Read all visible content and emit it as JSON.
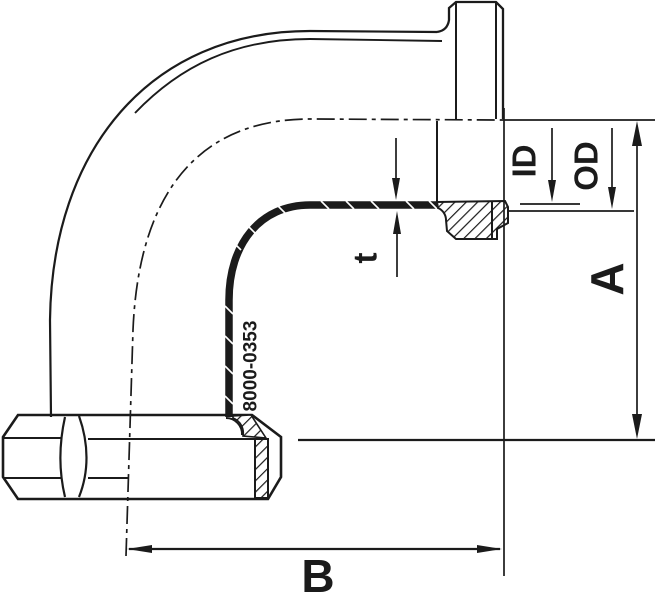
{
  "drawing": {
    "labels": {
      "inner_diameter": "ID",
      "outer_diameter": "OD",
      "wall_thickness": "t",
      "dim_height": "A",
      "dim_length": "B",
      "part_number": "8000-0353"
    },
    "colors": {
      "line": "#1b1b1b",
      "background": "#ffffff"
    }
  }
}
